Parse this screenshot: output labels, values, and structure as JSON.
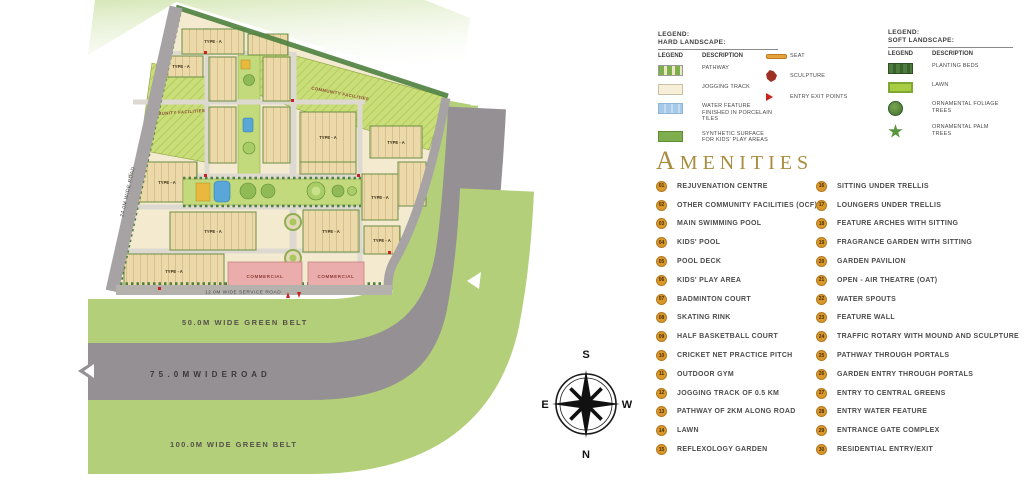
{
  "map": {
    "labels": {
      "road_24m": "24.0M WIDE ROAD",
      "service_road": "12.0M WIDE SERVICE ROAD",
      "green_belt_50": "50.0M WIDE GREEN BELT",
      "road_75": "7 5 . 0 M   W I D E   R O A D",
      "green_belt_100": "100.0M WIDE GREEN BELT",
      "community_facilities": "COMMUNITY FACILITIES",
      "type_a": "TYPE - A",
      "commercial": "COMMERCIAL"
    },
    "colors": {
      "green_belt": "#b4cf7a",
      "road_gray": "#949093",
      "block_tan": "#ecd9a9",
      "community_green": "#c9dd78",
      "commercial_pink": "#eaadab",
      "pool_blue": "#58a7d8",
      "marker_red": "#c8231d"
    }
  },
  "compass": {
    "north": "N",
    "south": "S",
    "east": "E",
    "west": "W"
  },
  "legend_hard": {
    "title1": "LEGEND:",
    "title2": "HARD LANDSCAPE:",
    "col_legend": "LEGEND",
    "col_description": "DESCRIPTION",
    "items": [
      {
        "label": "PATHWAY"
      },
      {
        "label": "JOGGING TRACK"
      },
      {
        "label": "WATER FEATURE FINISHED IN PORCELAIN TILES"
      },
      {
        "label": "SYNTHETIC SURFACE FOR KIDS' PLAY AREAS"
      }
    ]
  },
  "legend_markers": {
    "items": [
      {
        "label": "SEAT"
      },
      {
        "label": "SCULPTURE"
      },
      {
        "label": "ENTRY EXIT POINTS"
      }
    ]
  },
  "legend_soft": {
    "title1": "LEGEND:",
    "title2": "SOFT LANDSCAPE:",
    "col_legend": "LEGEND",
    "col_description": "DESCRIPTION",
    "items": [
      {
        "label": "PLANTING BEDS"
      },
      {
        "label": "LAWN"
      },
      {
        "label": "ORNAMENTAL FOLIAGE TREES"
      },
      {
        "label": "ORNAMENTAL PALM TREES"
      }
    ]
  },
  "amenities": {
    "title": "AMENITIES",
    "items_left": [
      {
        "num": "01",
        "label": "REJUVENATION CENTRE"
      },
      {
        "num": "02",
        "label": "OTHER COMMUNITY FACILITIES (OCF)"
      },
      {
        "num": "03",
        "label": "MAIN SWIMMING POOL"
      },
      {
        "num": "04",
        "label": "KIDS' POOL"
      },
      {
        "num": "05",
        "label": "POOL DECK"
      },
      {
        "num": "06",
        "label": "KIDS' PLAY AREA"
      },
      {
        "num": "07",
        "label": "BADMINTON COURT"
      },
      {
        "num": "08",
        "label": "SKATING RINK"
      },
      {
        "num": "09",
        "label": "HALF BASKETBALL COURT"
      },
      {
        "num": "10",
        "label": "CRICKET NET PRACTICE PITCH"
      },
      {
        "num": "11",
        "label": "OUTDOOR GYM"
      },
      {
        "num": "12",
        "label": "JOGGING TRACK OF 0.5 KM"
      },
      {
        "num": "13",
        "label": "PATHWAY OF 2KM ALONG ROAD"
      },
      {
        "num": "14",
        "label": "LAWN"
      },
      {
        "num": "15",
        "label": "REFLEXOLOGY GARDEN"
      }
    ],
    "items_right": [
      {
        "num": "16",
        "label": "SITTING UNDER TRELLIS"
      },
      {
        "num": "17",
        "label": "LOUNGERS UNDER TRELLIS"
      },
      {
        "num": "18",
        "label": "FEATURE ARCHES WITH SITTING"
      },
      {
        "num": "19",
        "label": "FRAGRANCE GARDEN WITH SITTING"
      },
      {
        "num": "20",
        "label": "GARDEN PAVILION"
      },
      {
        "num": "21",
        "label": "OPEN - AIR THEATRE (OAT)"
      },
      {
        "num": "22",
        "label": "WATER SPOUTS"
      },
      {
        "num": "23",
        "label": "FEATURE WALL"
      },
      {
        "num": "24",
        "label": "TRAFFIC ROTARY WITH MOUND AND SCULPTURE"
      },
      {
        "num": "25",
        "label": "PATHWAY THROUGH PORTALS"
      },
      {
        "num": "26",
        "label": "GARDEN ENTRY THROUGH PORTALS"
      },
      {
        "num": "27",
        "label": "ENTRY TO CENTRAL GREENS"
      },
      {
        "num": "28",
        "label": "ENTRY WATER FEATURE"
      },
      {
        "num": "29",
        "label": "ENTRANCE GATE COMPLEX"
      },
      {
        "num": "30",
        "label": "RESIDENTIAL ENTRY/EXIT"
      }
    ]
  }
}
